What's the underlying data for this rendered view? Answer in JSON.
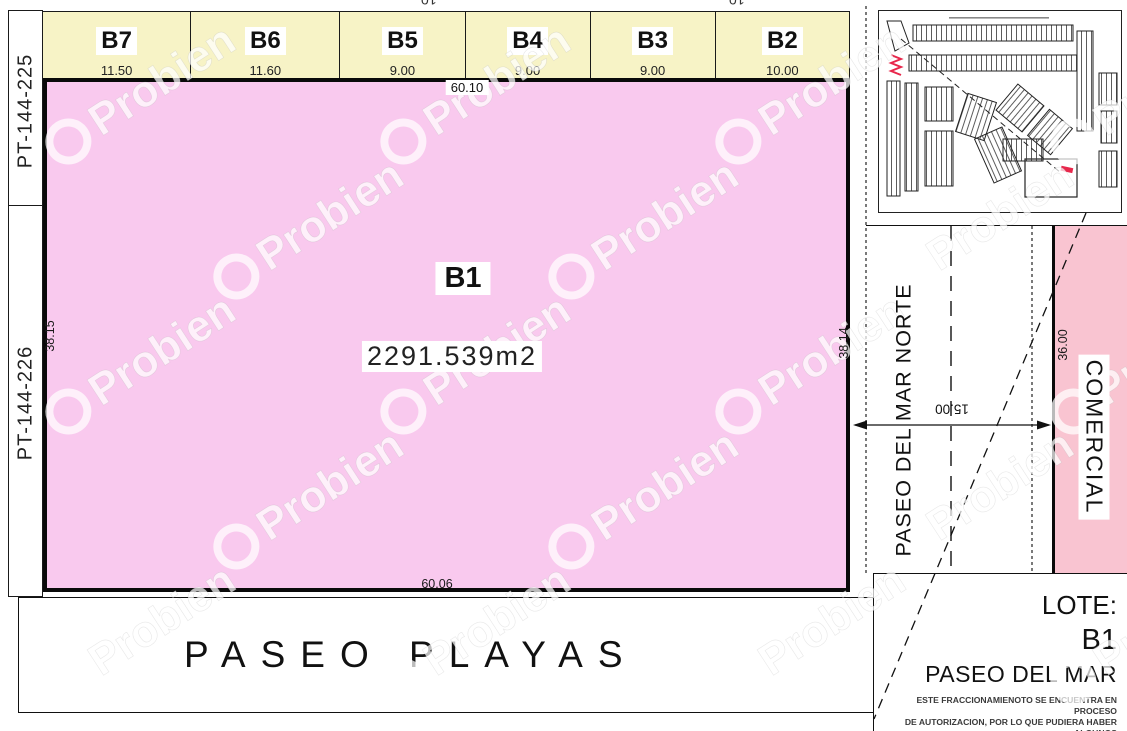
{
  "watermark": {
    "text": "Probien"
  },
  "left_boundary_labels": {
    "top": "PT-144-225",
    "bottom": "PT-144-226"
  },
  "top_lots": {
    "lots": [
      {
        "label": "B7",
        "dim": "11.50"
      },
      {
        "label": "B6",
        "dim": "11.60"
      },
      {
        "label": "B5",
        "dim": "9.00"
      },
      {
        "label": "B4",
        "dim": "9.00"
      },
      {
        "label": "B3",
        "dim": "9.00"
      },
      {
        "label": "B2",
        "dim": "10.00"
      }
    ],
    "clipped_top_dims": [
      "10",
      "10"
    ]
  },
  "parcel_b1": {
    "label": "B1",
    "area": "2291.539m2",
    "dim_top": "60.10",
    "dim_bottom": "60.06",
    "dim_left": "38.15",
    "dim_right": "38.14"
  },
  "streets": {
    "south": "PASEO PLAYAS",
    "east": "PASEO DEL MAR NORTE",
    "east_width": "15.00"
  },
  "commercial_lot": {
    "label": "COMERCIAL",
    "depth": "36.00"
  },
  "title_block": {
    "lote_label": "LOTE:",
    "lot_id": "B1",
    "project": "PASEO DEL MAR",
    "disclaimer": [
      "ESTE FRACCIONAMIENOTO SE ENCUENTRA EN PROCESO",
      "DE AUTORIZACION, POR LO QUE PUDIERA HABER ALGUNOS",
      "CAMBIOS EN LOS PLANOS FINALES AUTORIZADOS"
    ]
  },
  "colors": {
    "parcel_fill": "#f9c9ee",
    "lots_fill": "#f7f3c6",
    "commercial_fill": "#f9c4d1",
    "line": "#111111",
    "marker_red": "#e8274b"
  }
}
